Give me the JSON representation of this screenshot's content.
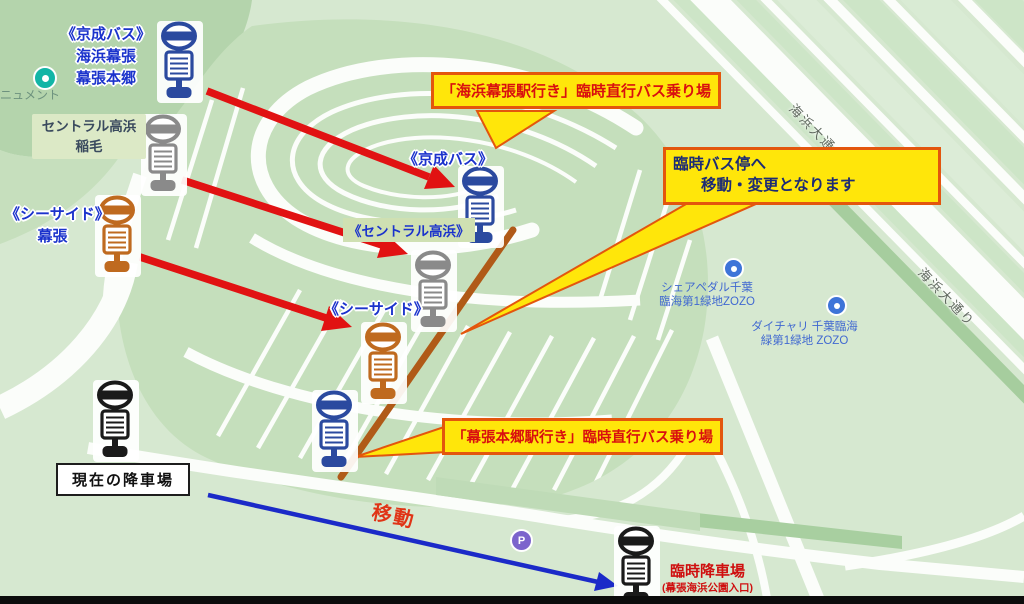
{
  "title": "幕張 臨時バス乗り場 案内図",
  "colors": {
    "arrow_red": "#e11212",
    "arrow_blue": "#1b2ac8",
    "route_brown": "#b05a18",
    "callout_bg": "#ffe60a",
    "callout_border": "#e3560d",
    "callout_red_text": "#d90f0f",
    "callout_navy_text": "#1c2b75",
    "label_blue": "#1b33cc",
    "keisei_blue": "#2b4a9f",
    "central_gray": "#8a8a8a",
    "seaside_orange": "#bf6a1f",
    "stop_black": "#1a1a1a"
  },
  "stops": [
    {
      "id": "keisei-origin",
      "color": "#2b4a9f",
      "x": 157,
      "y": 21
    },
    {
      "id": "central-origin",
      "color": "#8a8a8a",
      "x": 141,
      "y": 114
    },
    {
      "id": "seaside-origin",
      "color": "#bf6a1f",
      "x": 95,
      "y": 195
    },
    {
      "id": "keisei-new",
      "color": "#2b4a9f",
      "x": 458,
      "y": 166
    },
    {
      "id": "central-new",
      "color": "#8a8a8a",
      "x": 411,
      "y": 250
    },
    {
      "id": "seaside-new",
      "color": "#bf6a1f",
      "x": 361,
      "y": 322
    },
    {
      "id": "hongo-new",
      "color": "#2b4a9f",
      "x": 312,
      "y": 390
    },
    {
      "id": "current-dropoff",
      "color": "#1a1a1a",
      "x": 93,
      "y": 380
    },
    {
      "id": "temp-dropoff",
      "color": "#1a1a1a",
      "x": 614,
      "y": 526
    }
  ],
  "labels": {
    "keisei_origin_1": "《京成バス》",
    "keisei_origin_2": "海浜幕張",
    "keisei_origin_3": "幕張本郷",
    "central_origin_1": "セントラル高浜",
    "central_origin_2": "稲毛",
    "seaside_origin_1": "《シーサイド》",
    "seaside_origin_2": "幕張",
    "keisei_map": "《京成バス》",
    "central_map": "《セントラル高浜》",
    "seaside_map": "《シーサイド》",
    "current_dropoff": "現在の降車場",
    "temp_dropoff_1": "臨時降車場",
    "temp_dropoff_2": "(幕張海浜公園入口)",
    "move": "移動"
  },
  "callouts": {
    "kaihin_makuhari": "「海浜幕張駅行き」臨時直行バス乗り場",
    "temp_stop_line1": "臨時バス停へ",
    "temp_stop_line2": "移動・変更となります",
    "makuhari_hongo": "「幕張本郷駅行き」臨時直行バス乗り場"
  },
  "map_pois": {
    "monument": "ニュメント",
    "share_pedal_1": "シェアペダル千葉",
    "share_pedal_2": "臨海第1緑地ZOZO",
    "daichari_1": "ダイチャリ 千葉臨海",
    "daichari_2": "緑第1緑地 ZOZO",
    "road_name_1": "海浜大通り",
    "road_name_2": "海浜大通り",
    "parking_pin": "P"
  }
}
